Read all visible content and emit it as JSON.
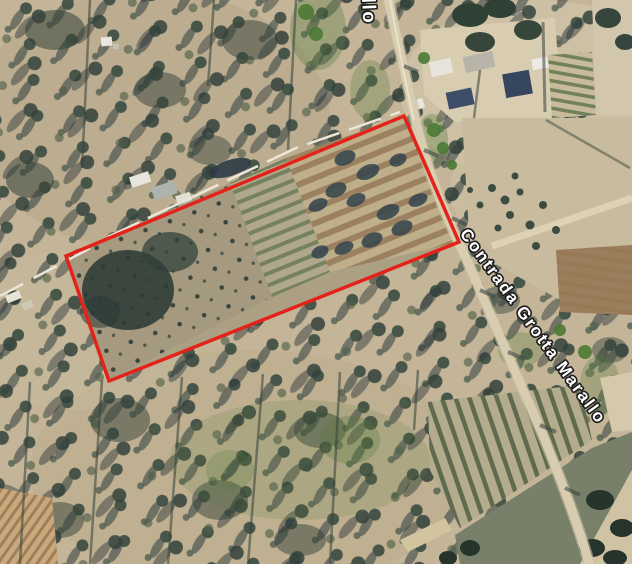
{
  "map": {
    "road_label": "Contrada Grotta Marallo",
    "road_label_partial": "llo",
    "label_fill": "#ffffff",
    "label_outline": "#1d1d1d",
    "parcel": {
      "outline_color": "#e3231a",
      "corners": "66,256 404,116 459,242 109,381"
    }
  }
}
